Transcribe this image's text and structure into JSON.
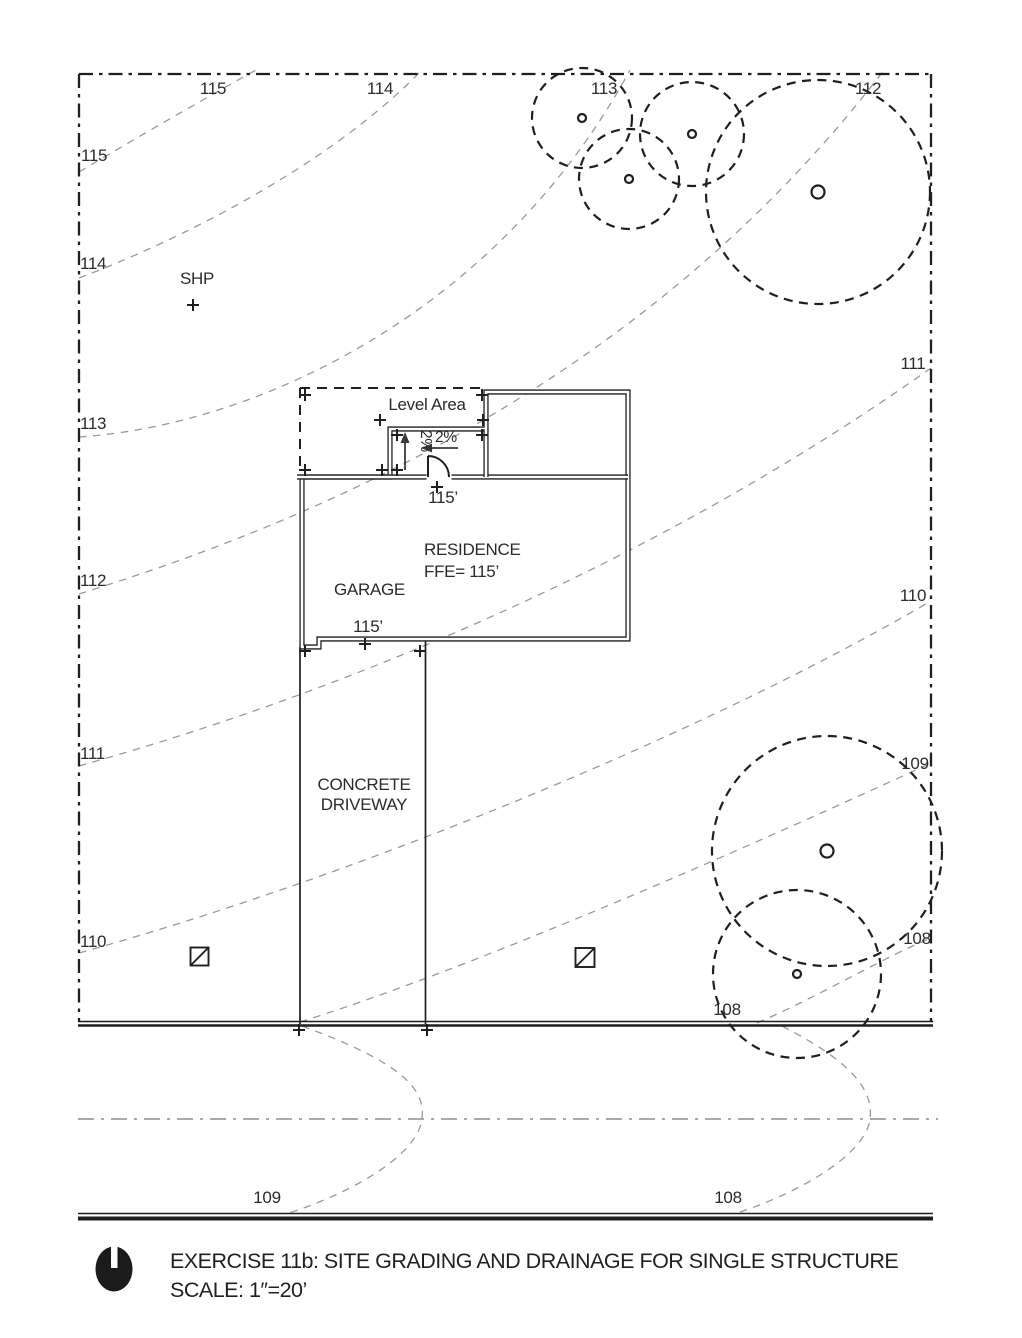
{
  "colors": {
    "ink": "#1f1f1f",
    "contour_gray": "#9a9a9a",
    "centerline_gray": "#8f8f8f"
  },
  "contour_labels": {
    "top": [
      "115",
      "114",
      "113",
      "112"
    ],
    "left": [
      "115",
      "114",
      "113",
      "112",
      "111",
      "110"
    ],
    "right": [
      "111",
      "110",
      "109",
      "108"
    ],
    "near_street": "108",
    "below_street": [
      "109",
      "108"
    ]
  },
  "annotations": {
    "shp": "SHP",
    "level_area": "Level Area",
    "slope_horizontal": "2%",
    "slope_vertical": "2%",
    "entry_elevation": "115’",
    "residence": "RESIDENCE",
    "residence_ffe": "FFE= 115’",
    "garage": "GARAGE",
    "garage_elevation": "115’",
    "driveway_line1": "CONCRETE",
    "driveway_line2": "DRIVEWAY"
  },
  "title_block": {
    "title": "EXERCISE 11b: SITE GRADING AND DRAINAGE FOR SINGLE STRUCTURE",
    "scale": "SCALE: 1″=20’"
  }
}
